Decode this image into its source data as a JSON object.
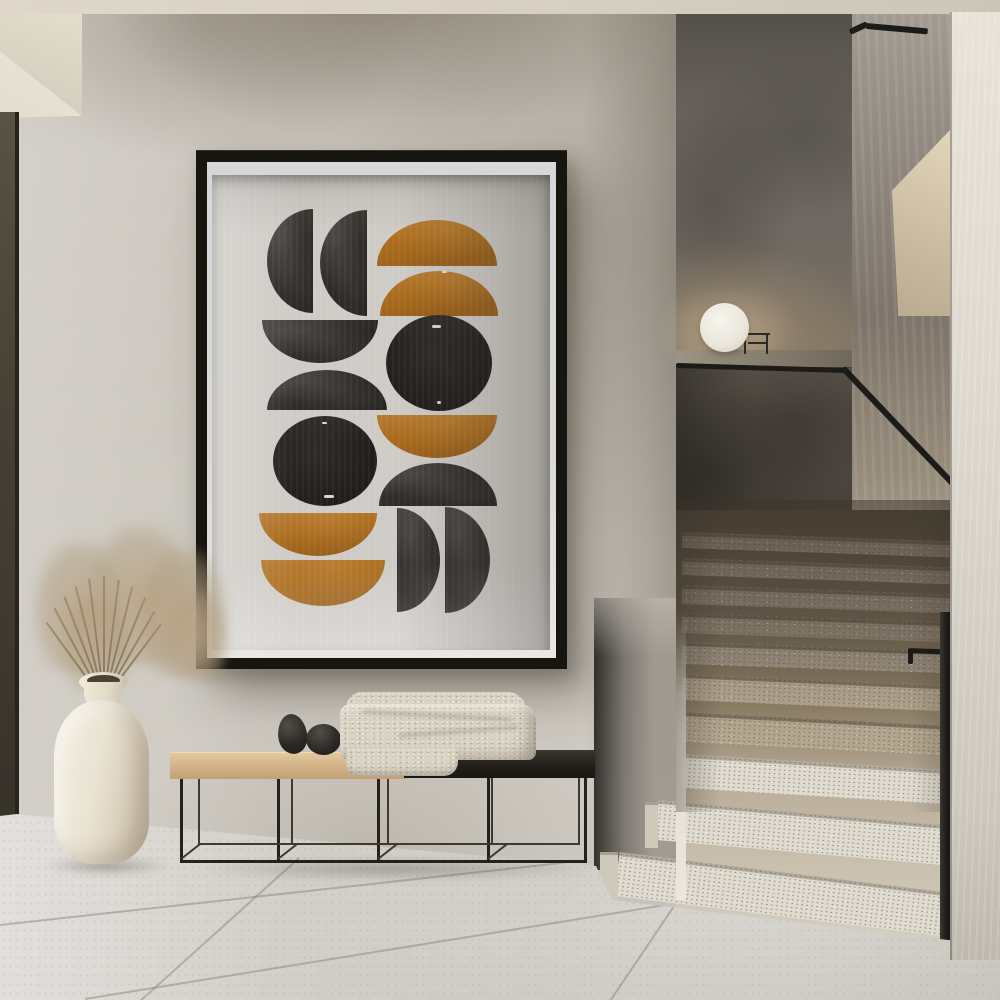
{
  "scene": {
    "description": "Minimalist hallway interior: framed abstract mid-century print on a plaster wall above a metal bench, cream vase with dried pampas grass at left, terrazzo staircase with black handrail and sphere lamp at right",
    "objects": {
      "art_poster": "framed abstract geometric art print",
      "bench": "black metal frame bench with wood and black seat",
      "blanket": "folded beige knit throw",
      "stones": "two black decorative stones",
      "vase": "cream ceramic floor vase",
      "plant": "dried pampas grass",
      "lamp": "white sphere lamp on stair ledge",
      "staircase": "terrazzo stairs with black metal handrail",
      "floor": "large-format stone tile floor"
    }
  },
  "palette": {
    "ceiling": "#d9d2c5",
    "wall": "#c8c3ba",
    "door_dark": "#4e4739",
    "frame": "#17150f",
    "mat": "#d5d7d9",
    "paper": "#cfccc7",
    "art_black": "#312e2a",
    "art_ink": "#201e1b",
    "art_ochre": "#ad6d1e",
    "back_wall": "#6f6962",
    "half_wall": "#625b51",
    "ledge": "#8a8173",
    "rail": "#1d1b18",
    "step_light": "#e0dbd0",
    "step_mid": "#b3a68f",
    "step_dark": "#8d8171",
    "floor": "#ccc9c2",
    "right_wall": "#ded9cf",
    "wood": "#d2b186",
    "bench_black": "#24211d",
    "blanket": "#d8d2c3",
    "vase": "#e9e2d2",
    "grass": "#a08c6f",
    "lamp": "#f1eee6"
  },
  "artwork": {
    "style": "watercolor half-circles and circles, charcoal black and ochre on warm grey paper",
    "shapes": [
      {
        "t": "half",
        "d": "left",
        "cx": 101,
        "cy": 86,
        "rx": 46,
        "ry": 52,
        "c": "black"
      },
      {
        "t": "half",
        "d": "left",
        "cx": 155,
        "cy": 88,
        "rx": 47,
        "ry": 53,
        "c": "black"
      },
      {
        "t": "half",
        "d": "up",
        "cx": 225,
        "cy": 91,
        "rx": 60,
        "ry": 46,
        "c": "orange"
      },
      {
        "t": "half",
        "d": "up",
        "cx": 227,
        "cy": 141,
        "rx": 59,
        "ry": 45,
        "c": "orange"
      },
      {
        "t": "half",
        "d": "down",
        "cx": 108,
        "cy": 145,
        "rx": 58,
        "ry": 43,
        "c": "black"
      },
      {
        "t": "circle",
        "cx": 227,
        "cy": 188,
        "rx": 53,
        "ry": 48,
        "c": "black"
      },
      {
        "t": "half",
        "d": "up",
        "cx": 115,
        "cy": 235,
        "rx": 60,
        "ry": 40,
        "c": "black"
      },
      {
        "t": "circle",
        "cx": 113,
        "cy": 286,
        "rx": 52,
        "ry": 45,
        "c": "black"
      },
      {
        "t": "half",
        "d": "down",
        "cx": 225,
        "cy": 240,
        "rx": 60,
        "ry": 43,
        "c": "orange"
      },
      {
        "t": "half",
        "d": "up",
        "cx": 226,
        "cy": 331,
        "rx": 59,
        "ry": 43,
        "c": "black"
      },
      {
        "t": "half",
        "d": "down",
        "cx": 106,
        "cy": 338,
        "rx": 59,
        "ry": 43,
        "c": "orange"
      },
      {
        "t": "half",
        "d": "down",
        "cx": 111,
        "cy": 385,
        "rx": 62,
        "ry": 46,
        "c": "orange"
      },
      {
        "t": "half",
        "d": "right",
        "cx": 185,
        "cy": 385,
        "rx": 43,
        "ry": 52,
        "c": "black"
      },
      {
        "t": "half",
        "d": "right",
        "cx": 233,
        "cy": 385,
        "rx": 45,
        "ry": 53,
        "c": "black"
      }
    ],
    "flecks": [
      {
        "x": 220,
        "y": 150,
        "w": 9,
        "h": 3
      },
      {
        "x": 225,
        "y": 226,
        "w": 4,
        "h": 3
      },
      {
        "x": 110,
        "y": 247,
        "w": 5,
        "h": 2
      },
      {
        "x": 112,
        "y": 320,
        "w": 10,
        "h": 3
      },
      {
        "x": 230,
        "y": 96,
        "w": 5,
        "h": 2
      }
    ]
  },
  "geometry": [
    {
      "target": "stair-area",
      "name": "step-riser",
      "items": [
        {
          "x": 682,
          "y": 532,
          "w": 268,
          "h": 16,
          "r": 2,
          "c": "sr-dark"
        },
        {
          "x": 682,
          "y": 558,
          "w": 268,
          "h": 17,
          "r": 2,
          "c": "sr-dark"
        },
        {
          "x": 682,
          "y": 585,
          "w": 268,
          "h": 19,
          "r": 2,
          "c": "sr-dark"
        },
        {
          "x": 682,
          "y": 613,
          "w": 268,
          "h": 20,
          "r": 2,
          "c": "sr-dark"
        },
        {
          "x": 682,
          "y": 642,
          "w": 268,
          "h": 22,
          "r": 2,
          "c": "sr-dark2"
        },
        {
          "x": 682,
          "y": 674,
          "w": 268,
          "h": 26,
          "r": 2.5,
          "c": "sr-mid"
        },
        {
          "x": 682,
          "y": 712,
          "w": 268,
          "h": 30,
          "r": 3,
          "c": "sr-mid"
        },
        {
          "x": 682,
          "y": 754,
          "w": 268,
          "h": 34,
          "r": 3.5,
          "c": "sr-light"
        },
        {
          "x": 657,
          "y": 800,
          "w": 293,
          "h": 40,
          "r": 5,
          "c": "sr-light"
        },
        {
          "x": 617,
          "y": 852,
          "w": 333,
          "h": 44,
          "r": 7,
          "c": "sr-light"
        },
        {
          "x": 645,
          "y": 802,
          "w": 13,
          "h": 46,
          "c": "sr-side"
        },
        {
          "x": 600,
          "y": 852,
          "w": 18,
          "h": 54,
          "c": "sr-side"
        }
      ]
    },
    {
      "target": "overlay-rails",
      "name": "handrail",
      "items": [
        {
          "x": 676,
          "y": 363,
          "w": 170,
          "h": 5,
          "r": 1.7,
          "c": "rail",
          "n": "handrail-landing"
        },
        {
          "x": 843,
          "y": 365,
          "w": 160,
          "h": 6,
          "r": 46.5,
          "c": "rail",
          "n": "handrail-diagonal"
        },
        {
          "x": 866,
          "y": 23,
          "w": 62,
          "h": 6,
          "r": 5,
          "c": "rail",
          "n": "handrail-upper"
        },
        {
          "x": 850,
          "y": 29,
          "w": 19,
          "h": 6,
          "r": -25,
          "c": "rail",
          "n": "handrail-upper-end"
        },
        {
          "x": 908,
          "y": 648,
          "w": 40,
          "h": 5,
          "r": 2,
          "c": "rail",
          "n": "railing-bracket"
        },
        {
          "x": 908,
          "y": 650,
          "w": 5,
          "h": 14,
          "c": "rail",
          "n": "railing-bracket-drop"
        },
        {
          "x": 940,
          "y": 612,
          "w": 10,
          "h": 328,
          "c": "rail-post",
          "n": "railing-post"
        },
        {
          "x": 744,
          "y": 333,
          "w": 26,
          "h": 2,
          "c": "wire",
          "n": "lamp-stand"
        },
        {
          "x": 744,
          "y": 334,
          "w": 2,
          "h": 20,
          "c": "wire",
          "n": "lamp-stand"
        },
        {
          "x": 766,
          "y": 333,
          "w": 2,
          "h": 21,
          "c": "wire",
          "n": "lamp-stand"
        },
        {
          "x": 748,
          "y": 342,
          "w": 20,
          "h": 2,
          "c": "wire",
          "n": "lamp-stand"
        }
      ]
    },
    {
      "target": "bench-lines",
      "name": "bench-frame-bar",
      "items": [
        {
          "x": 180,
          "y": 777,
          "w": 3,
          "h": 86,
          "c": "bench-bar"
        },
        {
          "x": 277,
          "y": 777,
          "w": 3,
          "h": 86,
          "c": "bench-bar"
        },
        {
          "x": 377,
          "y": 777,
          "w": 3,
          "h": 86,
          "c": "bench-bar"
        },
        {
          "x": 487,
          "y": 777,
          "w": 3,
          "h": 86,
          "c": "bench-bar"
        },
        {
          "x": 584,
          "y": 777,
          "w": 3,
          "h": 86,
          "c": "bench-bar"
        },
        {
          "x": 198,
          "y": 777,
          "w": 2,
          "h": 67,
          "c": "bench-bar-back"
        },
        {
          "x": 291,
          "y": 777,
          "w": 2,
          "h": 67,
          "c": "bench-bar-back"
        },
        {
          "x": 387,
          "y": 777,
          "w": 2,
          "h": 67,
          "c": "bench-bar-back"
        },
        {
          "x": 491,
          "y": 777,
          "w": 2,
          "h": 67,
          "c": "bench-bar-back"
        },
        {
          "x": 578,
          "y": 777,
          "w": 2,
          "h": 67,
          "c": "bench-bar-back"
        },
        {
          "x": 180,
          "y": 860,
          "w": 407,
          "h": 3,
          "c": "bench-bar"
        },
        {
          "x": 198,
          "y": 843,
          "w": 382,
          "h": 2,
          "c": "bench-bar-back"
        },
        {
          "x": 181,
          "y": 858,
          "w": 24,
          "h": 2,
          "r": -38,
          "c": "bench-bar-back"
        },
        {
          "x": 278,
          "y": 858,
          "w": 24,
          "h": 2,
          "r": -38,
          "c": "bench-bar-back"
        },
        {
          "x": 378,
          "y": 858,
          "w": 24,
          "h": 2,
          "r": -38,
          "c": "bench-bar-back"
        },
        {
          "x": 488,
          "y": 858,
          "w": 24,
          "h": 2,
          "r": -38,
          "c": "bench-bar-back"
        }
      ]
    },
    {
      "target": "floor-lines",
      "name": "tile-grout-line",
      "items": [
        {
          "x": 0,
          "y": 124,
          "w": 640,
          "h": 2,
          "r": -6.3,
          "c": "tl"
        },
        {
          "x": 85,
          "y": 198,
          "w": 700,
          "h": 2,
          "r": -9.2,
          "c": "tl"
        },
        {
          "x": 298,
          "y": 58,
          "w": 2,
          "h": 215,
          "r": 48,
          "o": "top",
          "c": "tl"
        },
        {
          "x": 688,
          "y": 84,
          "w": 2,
          "h": 142,
          "r": 34,
          "o": "top",
          "c": "tl"
        }
      ]
    },
    {
      "target": "plant-stems",
      "name": "grass-stem",
      "items": [
        {
          "x": 98,
          "y": 597,
          "w": 2,
          "h": 95,
          "r": -28,
          "o": "bottom",
          "c": "stem"
        },
        {
          "x": 100,
          "y": 590,
          "w": 2,
          "h": 102,
          "r": -21,
          "o": "bottom",
          "c": "stem"
        },
        {
          "x": 101,
          "y": 583,
          "w": 2,
          "h": 109,
          "r": -14,
          "o": "bottom",
          "c": "stem"
        },
        {
          "x": 102,
          "y": 578,
          "w": 2,
          "h": 114,
          "r": -7,
          "o": "bottom",
          "c": "stem"
        },
        {
          "x": 103,
          "y": 576,
          "w": 2,
          "h": 116,
          "r": 0,
          "o": "bottom",
          "c": "stem"
        },
        {
          "x": 104,
          "y": 579,
          "w": 2,
          "h": 113,
          "r": 7,
          "o": "bottom",
          "c": "stem"
        },
        {
          "x": 105,
          "y": 584,
          "w": 2,
          "h": 108,
          "r": 14,
          "o": "bottom",
          "c": "stem"
        },
        {
          "x": 106,
          "y": 590,
          "w": 2,
          "h": 102,
          "r": 22,
          "o": "bottom",
          "c": "stem"
        },
        {
          "x": 107,
          "y": 599,
          "w": 2,
          "h": 93,
          "r": 30,
          "o": "bottom",
          "c": "stem"
        },
        {
          "x": 96,
          "y": 606,
          "w": 2,
          "h": 86,
          "r": -36,
          "o": "bottom",
          "c": "stem"
        },
        {
          "x": 109,
          "y": 607,
          "w": 2,
          "h": 85,
          "r": 37,
          "o": "bottom",
          "c": "stem"
        }
      ]
    }
  ]
}
